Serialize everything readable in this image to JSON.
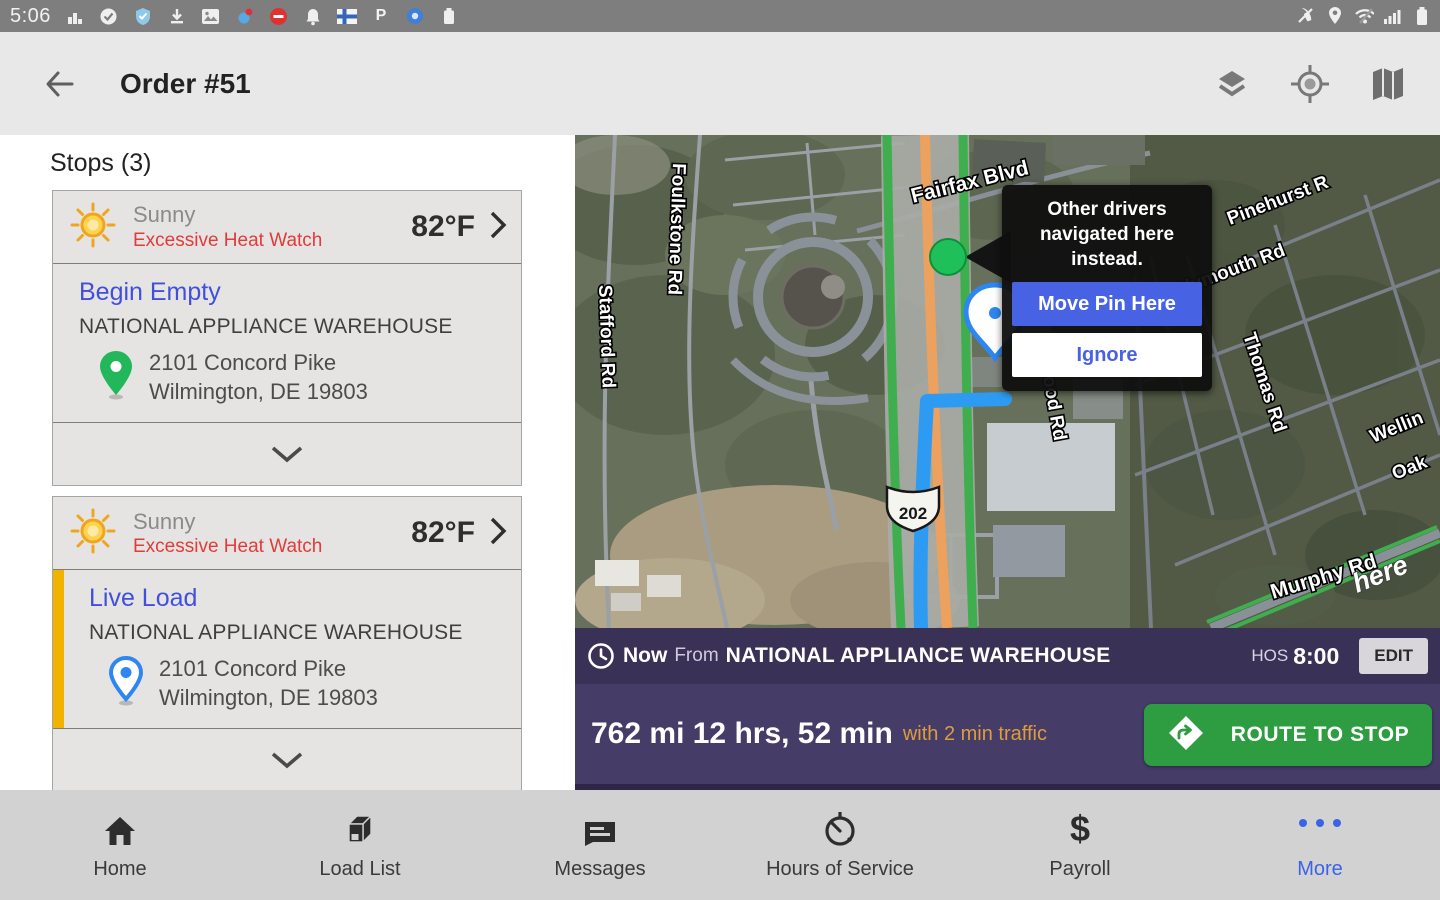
{
  "status_bar": {
    "time": "5:06",
    "left_icons": [
      "signal-chart-icon",
      "check-circle-icon",
      "shield-icon",
      "download-icon",
      "photo-icon",
      "weather-badge-icon",
      "do-not-disturb-icon",
      "bell-icon",
      "flag-icon",
      "p-icon",
      "blue-circle-icon",
      "battery-small-icon"
    ],
    "right_icons": [
      "phone-mute-icon",
      "location-pin-icon",
      "wifi-off-icon",
      "signal-bars-icon",
      "battery-icon"
    ],
    "p_glyph": "P"
  },
  "header": {
    "title": "Order #51",
    "icons": [
      "layers-icon",
      "locate-icon",
      "map-icon"
    ]
  },
  "stops_panel": {
    "title": "Stops (3)",
    "stops": [
      {
        "weather": {
          "condition": "Sunny",
          "alert": "Excessive Heat Watch",
          "temperature": "82°F"
        },
        "stop_type": "Begin Empty",
        "location_name": "NATIONAL APPLIANCE WAREHOUSE",
        "address_line1": "2101 Concord Pike",
        "address_line2": "Wilmington, DE 19803",
        "pin_color": "green"
      },
      {
        "weather": {
          "condition": "Sunny",
          "alert": "Excessive Heat Watch",
          "temperature": "82°F"
        },
        "stop_type": "Live Load",
        "location_name": "NATIONAL APPLIANCE WAREHOUSE",
        "address_line1": "2101 Concord Pike",
        "address_line2": "Wilmington, DE 19803",
        "pin_color": "blue"
      }
    ]
  },
  "map": {
    "labels": [
      {
        "text": "Stafford  Rd"
      },
      {
        "text": "Foulkstone  Rd"
      },
      {
        "text": "Fairfax  Blvd"
      },
      {
        "text": "Pinehurst  R"
      },
      {
        "text": "Plymouth  Rd"
      },
      {
        "text": "Thomas  Rd"
      },
      {
        "text": "Wellin"
      },
      {
        "text": "Oak"
      },
      {
        "text": "ood  Rd"
      },
      {
        "text": "Murphy  Rd"
      }
    ],
    "shield": "202",
    "watermark": "here",
    "tooltip": {
      "message": "Other drivers navigated here instead.",
      "primary_label": "Move Pin Here",
      "secondary_label": "Ignore"
    }
  },
  "route_bar": {
    "now_label": "Now",
    "from_label": "From",
    "location": "NATIONAL APPLIANCE WAREHOUSE",
    "hos_label": "HOS",
    "hos_value": "8:00",
    "edit_label": "EDIT"
  },
  "route_info": {
    "summary": "762 mi 12 hrs, 52 min",
    "traffic_note": "with 2 min traffic",
    "route_button_label": "ROUTE TO STOP"
  },
  "bottom_nav": {
    "items": [
      {
        "label": "Home"
      },
      {
        "label": "Load List"
      },
      {
        "label": "Messages"
      },
      {
        "label": "Hours of Service"
      },
      {
        "label": "Payroll"
      },
      {
        "label": "More"
      }
    ],
    "active": "More",
    "payroll_glyph": "$"
  },
  "colors": {
    "accent_blue": "#4050dd",
    "alert_red": "#e23b3b",
    "highlight_yellow": "#f2b300",
    "purple_bar": "#3a3156",
    "purple_panel": "#453c68",
    "green_button": "#2e9c41",
    "traffic_orange": "#dd9d3e",
    "nav_active_blue": "#3b63e8",
    "pin_green": "#22b75b",
    "pin_blue": "#2e86f0",
    "route_blue": "#2e9bf2",
    "tooltip_button_blue": "#4763e4"
  }
}
